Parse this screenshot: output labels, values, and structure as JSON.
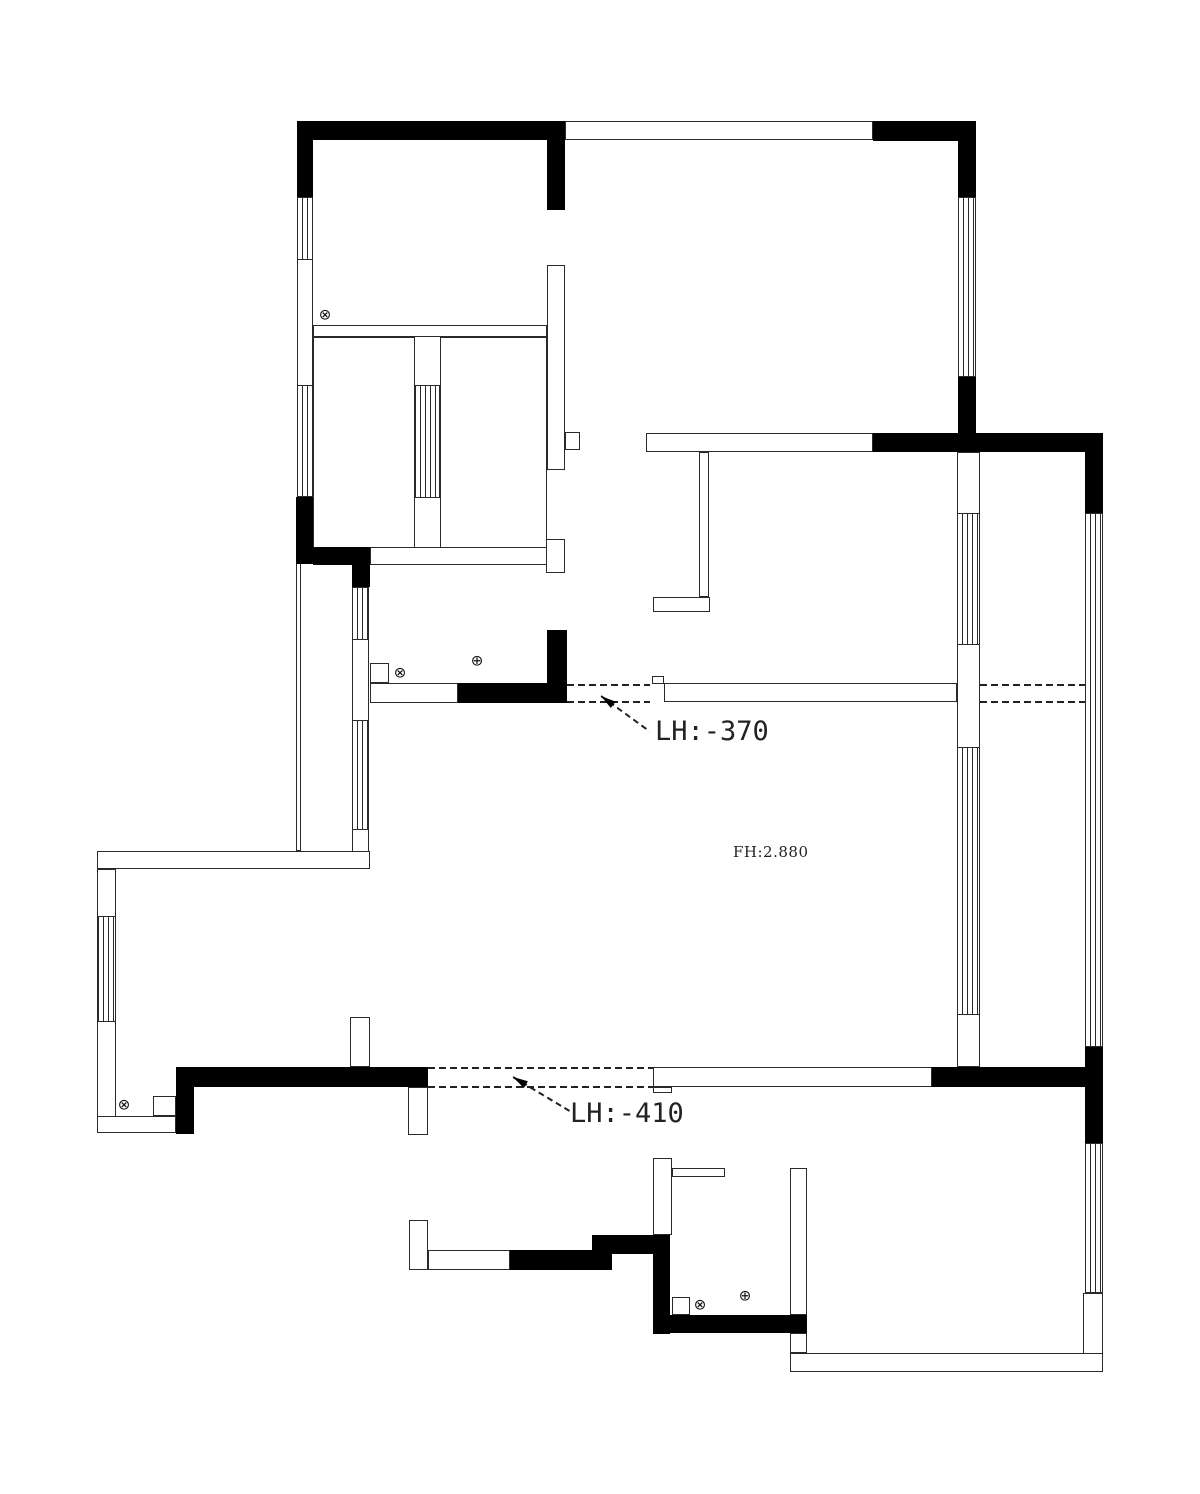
{
  "page": {
    "width": 1200,
    "height": 1494,
    "background": "#ffffff"
  },
  "annotations": {
    "level_note_upper": "LH:-370",
    "level_note_lower": "LH:-410",
    "floor_height_note": "FH:2.880"
  },
  "colors": {
    "line": "#2a2a2a",
    "solid_wall": "#000000",
    "text": "#222222"
  },
  "symbols": [
    {
      "glyph": "⊗",
      "name": "drain-symbol",
      "x": 325,
      "y": 315
    },
    {
      "glyph": "⊗",
      "name": "drain-symbol",
      "x": 400,
      "y": 673
    },
    {
      "glyph": "⊕",
      "name": "riser-symbol",
      "x": 477,
      "y": 661
    },
    {
      "glyph": "⊗",
      "name": "drain-symbol",
      "x": 124,
      "y": 1105
    },
    {
      "glyph": "⊗",
      "name": "drain-symbol",
      "x": 700,
      "y": 1305
    },
    {
      "glyph": "⊕",
      "name": "riser-symbol",
      "x": 745,
      "y": 1296
    }
  ],
  "plan": {
    "black_walls": [
      [
        297,
        121,
        268,
        19
      ],
      [
        297,
        140,
        16,
        57
      ],
      [
        547,
        140,
        18,
        70
      ],
      [
        873,
        121,
        103,
        20
      ],
      [
        958,
        141,
        18,
        56
      ],
      [
        958,
        377,
        18,
        56
      ],
      [
        873,
        433,
        230,
        19
      ],
      [
        1085,
        452,
        18,
        61
      ],
      [
        1085,
        1047,
        18,
        96
      ],
      [
        932,
        1067,
        171,
        20
      ],
      [
        296,
        497,
        17,
        67
      ],
      [
        313,
        547,
        57,
        18
      ],
      [
        352,
        565,
        18,
        22
      ],
      [
        458,
        683,
        109,
        20
      ],
      [
        547,
        630,
        20,
        53
      ],
      [
        176,
        1067,
        18,
        67
      ],
      [
        194,
        1067,
        234,
        20
      ],
      [
        592,
        1235,
        78,
        19
      ],
      [
        510,
        1250,
        102,
        20
      ],
      [
        653,
        1254,
        17,
        80
      ],
      [
        670,
        1315,
        137,
        18
      ]
    ],
    "thin_walls": [
      [
        565,
        121,
        308,
        19
      ],
      [
        297,
        197,
        16,
        300
      ],
      [
        313,
        325,
        234,
        12
      ],
      [
        313,
        337,
        102,
        211
      ],
      [
        440,
        337,
        107,
        211
      ],
      [
        547,
        265,
        18,
        205
      ],
      [
        565,
        432,
        15,
        18
      ],
      [
        546,
        539,
        19,
        34
      ],
      [
        370,
        547,
        177,
        18
      ],
      [
        352,
        587,
        17,
        282
      ],
      [
        296,
        563,
        5,
        288
      ],
      [
        97,
        851,
        273,
        18
      ],
      [
        97,
        869,
        19,
        264
      ],
      [
        97,
        1116,
        79,
        17
      ],
      [
        153,
        1096,
        23,
        20
      ],
      [
        350,
        1017,
        20,
        50
      ],
      [
        408,
        1087,
        20,
        48
      ],
      [
        370,
        683,
        88,
        20
      ],
      [
        370,
        663,
        19,
        20
      ],
      [
        664,
        683,
        293,
        19
      ],
      [
        652,
        676,
        12,
        8
      ],
      [
        957,
        452,
        23,
        615
      ],
      [
        646,
        433,
        227,
        19
      ],
      [
        699,
        452,
        10,
        145
      ],
      [
        653,
        597,
        57,
        15
      ],
      [
        1083,
        1293,
        20,
        79
      ],
      [
        790,
        1353,
        313,
        19
      ],
      [
        653,
        1158,
        19,
        77
      ],
      [
        672,
        1168,
        53,
        9
      ],
      [
        790,
        1168,
        17,
        147
      ],
      [
        409,
        1220,
        19,
        50
      ],
      [
        428,
        1250,
        82,
        20
      ],
      [
        653,
        1067,
        279,
        20
      ],
      [
        653,
        1087,
        19,
        6
      ],
      [
        672,
        1297,
        18,
        18
      ],
      [
        790,
        1333,
        17,
        20
      ]
    ],
    "windows": [
      [
        297,
        197,
        16,
        63
      ],
      [
        297,
        385,
        16,
        112
      ],
      [
        958,
        197,
        18,
        180
      ],
      [
        415,
        385,
        25,
        113
      ],
      [
        352,
        587,
        17,
        53
      ],
      [
        352,
        720,
        17,
        110
      ],
      [
        98,
        916,
        18,
        106
      ],
      [
        957,
        513,
        23,
        132
      ],
      [
        957,
        747,
        23,
        268
      ],
      [
        1085,
        513,
        18,
        534
      ],
      [
        1085,
        1143,
        18,
        150
      ]
    ],
    "dashes": [
      [
        567,
        684,
        83
      ],
      [
        567,
        701,
        83
      ],
      [
        980,
        684,
        105
      ],
      [
        980,
        701,
        105
      ],
      [
        428,
        1067,
        225
      ],
      [
        428,
        1086,
        225
      ]
    ],
    "leaders": [
      {
        "tip": [
          601,
          696
        ],
        "line_angle": 36,
        "arrow_angle": 216,
        "len": 60
      },
      {
        "tip": [
          513,
          1077
        ],
        "line_angle": 31,
        "arrow_angle": 211,
        "len": 68
      }
    ]
  }
}
